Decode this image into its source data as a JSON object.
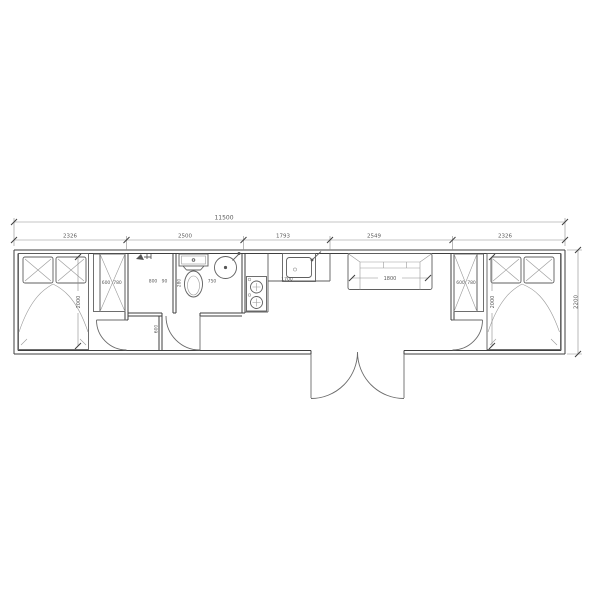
{
  "drawing": {
    "kind": "container-house-floor-plan",
    "colors": {
      "line": "#3f3f3f",
      "dim_text": "#5a5a5a",
      "background": "#ffffff"
    },
    "fixtures": [
      "double-bed",
      "wardrobe",
      "shower",
      "toilet",
      "washbasin",
      "stove",
      "kitchen-sink",
      "sofa",
      "double-entry-door"
    ],
    "dims": {
      "overall_length": "11500",
      "segments": [
        "2326",
        "2500",
        "1793",
        "2549",
        "2326"
      ],
      "overall_width": "2200"
    },
    "bedroom_left": {
      "bed_length": "2000",
      "wardrobe_depth": "600",
      "wardrobe_width": "780"
    },
    "bedroom_right": {
      "bed_length": "2000",
      "wardrobe_depth": "600",
      "wardrobe_width": "780"
    },
    "bathroom": {
      "shower_width": "800",
      "shower_gap": "90",
      "toilet_side": "280",
      "toilet_width": "750",
      "passage_width": "600"
    },
    "kitchen": {
      "counter_length": "1700"
    },
    "living": {
      "sofa_length": "1800"
    }
  }
}
